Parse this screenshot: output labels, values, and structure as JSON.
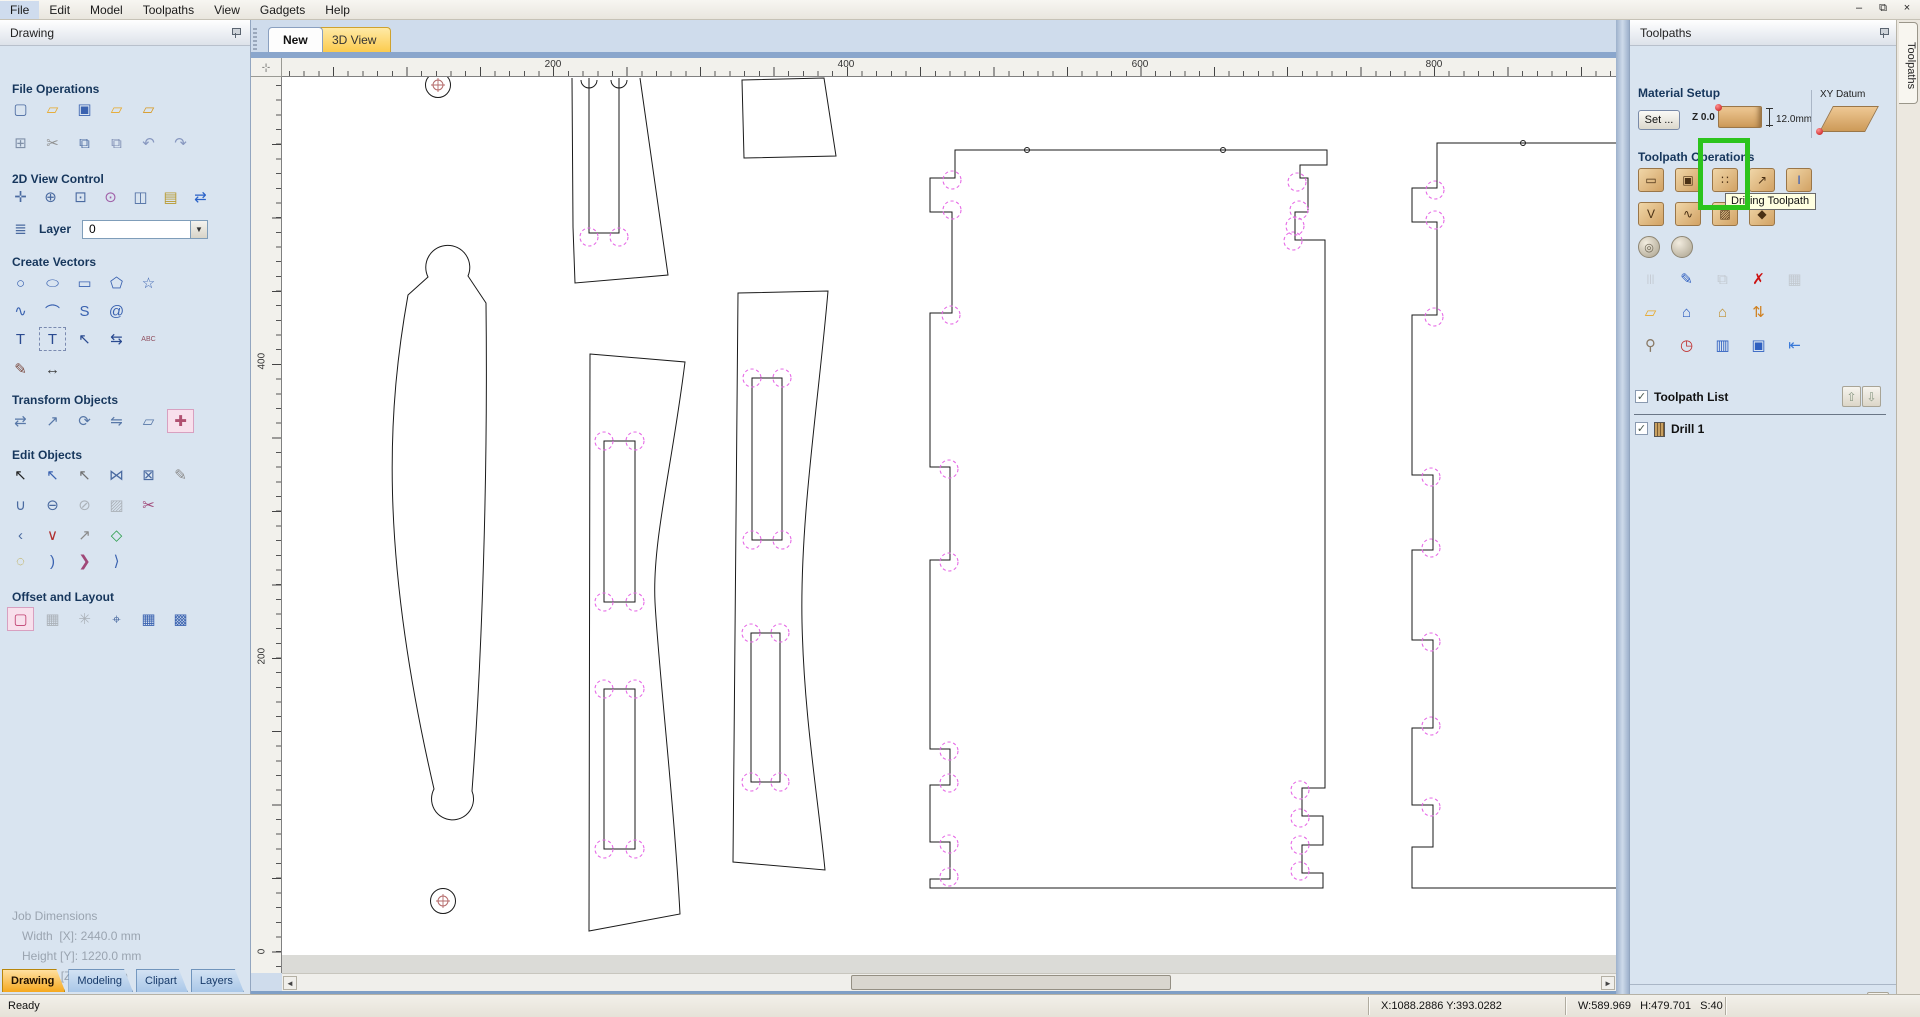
{
  "menu": {
    "items": [
      "File",
      "Edit",
      "Model",
      "Toolpaths",
      "View",
      "Gadgets",
      "Help"
    ]
  },
  "window_controls": {
    "minimize": "–",
    "restore": "⧉",
    "close": "×"
  },
  "drawing_panel": {
    "title": "Drawing",
    "headings": {
      "file_operations": "File Operations",
      "view_control": "2D View Control",
      "create_vectors": "Create Vectors",
      "transform_objects": "Transform Objects",
      "edit_objects": "Edit Objects",
      "offset_layout": "Offset and Layout"
    },
    "layer": {
      "label": "Layer",
      "value": "0"
    },
    "icons": {
      "file_row1": [
        {
          "n": "new-file",
          "g": "▢",
          "c": "#4a6aa0"
        },
        {
          "n": "open-file",
          "g": "▱",
          "c": "#e8a828"
        },
        {
          "n": "save-file",
          "g": "▣",
          "c": "#3a62b0"
        },
        {
          "n": "import-vectors",
          "g": "▱",
          "c": "#e8a828"
        },
        {
          "n": "export-vectors",
          "g": "▱",
          "c": "#d8981f"
        }
      ],
      "file_row2": [
        {
          "n": "job-setup",
          "g": "⊞",
          "c": "#8090a8"
        },
        {
          "n": "cut",
          "g": "✂",
          "c": "#909090"
        },
        {
          "n": "copy",
          "g": "⧉",
          "c": "#4a6aa0"
        },
        {
          "n": "paste",
          "g": "⧉",
          "c": "#7a8ab0"
        },
        {
          "n": "undo",
          "g": "↶",
          "c": "#8898c0"
        },
        {
          "n": "redo",
          "g": "↷",
          "c": "#8898c0"
        }
      ],
      "view2d": [
        {
          "n": "pan-view",
          "g": "✛",
          "c": "#4a6aa0"
        },
        {
          "n": "zoom-interactive",
          "g": "⊕",
          "c": "#4a6aa0"
        },
        {
          "n": "zoom-box",
          "g": "⊡",
          "c": "#4a6aa0"
        },
        {
          "n": "zoom-selected",
          "g": "⊙",
          "c": "#a060a8"
        },
        {
          "n": "zoom-fit",
          "g": "◫",
          "c": "#4a6aa0"
        },
        {
          "n": "zoom-extents",
          "g": "▤",
          "c": "#b89a30"
        },
        {
          "n": "switch-view",
          "g": "⇄",
          "c": "#2a62c8"
        }
      ],
      "layer_icon": [
        {
          "n": "layers",
          "g": "≣",
          "c": "#4a6aa0"
        }
      ],
      "cv_row1": [
        {
          "n": "draw-circle",
          "g": "○",
          "c": "#3a62b0"
        },
        {
          "n": "draw-ellipse",
          "g": "⬭",
          "c": "#3a62b0"
        },
        {
          "n": "draw-rectangle",
          "g": "▭",
          "c": "#3a62b0"
        },
        {
          "n": "draw-polygon",
          "g": "⬠",
          "c": "#3a62b0"
        },
        {
          "n": "draw-star",
          "g": "☆",
          "c": "#3a62b0"
        }
      ],
      "cv_row2": [
        {
          "n": "draw-polyline",
          "g": "∿",
          "c": "#3a62b0"
        },
        {
          "n": "draw-arc",
          "g": "⌒",
          "c": "#3a62b0"
        },
        {
          "n": "draw-curve",
          "g": "S",
          "c": "#3a62b0"
        },
        {
          "n": "draw-spiral",
          "g": "@",
          "c": "#3a62b0"
        }
      ],
      "cv_row3": [
        {
          "n": "draw-text",
          "g": "T",
          "c": "#2a4a90"
        },
        {
          "n": "draw-text-box",
          "g": "T",
          "c": "#2a4a90",
          "box": true
        },
        {
          "n": "edit-text",
          "g": "↖",
          "c": "#2a4a90"
        },
        {
          "n": "text-spacing",
          "g": "⇆",
          "c": "#2a4a90"
        },
        {
          "n": "text-on-arc",
          "g": "ABC",
          "c": "#905060",
          "fs": 7
        }
      ],
      "cv_row4": [
        {
          "n": "freehand-sketch",
          "g": "✎",
          "c": "#7a4a40"
        },
        {
          "n": "dimension",
          "g": "↔",
          "c": "#404040"
        }
      ],
      "transform_row": [
        {
          "n": "move-selection",
          "g": "⇄",
          "c": "#5878a8"
        },
        {
          "n": "set-size",
          "g": "↗",
          "c": "#5878a8"
        },
        {
          "n": "rotate",
          "g": "⟳",
          "c": "#5878a8"
        },
        {
          "n": "mirror",
          "g": "⇋",
          "c": "#5878a8"
        },
        {
          "n": "distort",
          "g": "▱",
          "c": "#5878a8"
        },
        {
          "n": "align-objects",
          "g": "✚",
          "c": "#b05070",
          "sel": true
        }
      ],
      "edit_row1": [
        {
          "n": "select-tool",
          "g": "↖",
          "c": "#222222"
        },
        {
          "n": "node-edit",
          "g": "↖",
          "c": "#3a62b0"
        },
        {
          "n": "move-nodes",
          "g": "↖",
          "c": "#707070"
        },
        {
          "n": "join-vectors",
          "g": "⋈",
          "c": "#4a6aa0"
        },
        {
          "n": "close-vector",
          "g": "⊠",
          "c": "#4a6aa0"
        },
        {
          "n": "measure-tool",
          "g": "✎",
          "c": "#8a8a8a"
        }
      ],
      "edit_row2": [
        {
          "n": "weld-vectors",
          "g": "∪",
          "c": "#4a6aa0"
        },
        {
          "n": "subtract-vectors",
          "g": "⊖",
          "c": "#4a6aa0"
        },
        {
          "n": "trim-vectors",
          "g": "⊘",
          "c": "#4a6aa0",
          "gray": true
        },
        {
          "n": "slice-vectors",
          "g": "▨",
          "c": "#4a6aa0",
          "gray": true
        },
        {
          "n": "vector-scissors",
          "g": "✂",
          "c": "#a04878"
        }
      ],
      "edit_row3": [
        {
          "n": "fillet-tool",
          "g": "‹",
          "c": "#4a6aa0"
        },
        {
          "n": "insert-node",
          "g": "∨",
          "c": "#b03030"
        },
        {
          "n": "extend-vector",
          "g": "↗",
          "c": "#8a8a8a"
        },
        {
          "n": "fit-curves",
          "g": "◇",
          "c": "#30a050"
        }
      ],
      "edit_row4": [
        {
          "n": "show-nodes",
          "g": "◌",
          "c": "#b8a030"
        },
        {
          "n": "fit-arc-1",
          "g": ")",
          "c": "#3a62b0"
        },
        {
          "n": "fit-arc-2",
          "g": "❯",
          "c": "#a04878"
        },
        {
          "n": "fit-arc-3",
          "g": "⟩",
          "c": "#3a62b0"
        }
      ],
      "offset_row": [
        {
          "n": "offset-vectors",
          "g": "▢",
          "c": "#c04070",
          "sel": true
        },
        {
          "n": "array-copy",
          "g": "▦",
          "c": "#4a6aa0",
          "gray": true
        },
        {
          "n": "circular-array",
          "g": "✳",
          "c": "#4a6aa0",
          "gray": true
        },
        {
          "n": "nest-parts",
          "g": "⌖",
          "c": "#4a6aa0"
        },
        {
          "n": "block-copy",
          "g": "▦",
          "c": "#3a62b0"
        },
        {
          "n": "nesting-layout",
          "g": "▩",
          "c": "#3a62b0"
        }
      ]
    },
    "job_dimensions": {
      "title": "Job Dimensions",
      "width": "Width  [X]: 2440.0 mm",
      "height": "Height [Y]: 1220.0 mm",
      "depth": "Depth  [Z]: 12.0 mm"
    },
    "tabs": [
      {
        "label": "Drawing",
        "active": true
      },
      {
        "label": "Modeling",
        "active": false
      },
      {
        "label": "Clipart",
        "active": false
      },
      {
        "label": "Layers",
        "active": false
      }
    ]
  },
  "canvas": {
    "tabs": [
      {
        "label": "New"
      },
      {
        "label": "3D View"
      }
    ],
    "h_ruler": [
      {
        "label": "200",
        "x": 271
      },
      {
        "label": "400",
        "x": 564
      },
      {
        "label": "600",
        "x": 858
      },
      {
        "label": "800",
        "x": 1152
      }
    ],
    "v_ruler": [
      {
        "label": "400",
        "y": 280
      },
      {
        "label": "200",
        "y": 575
      },
      {
        "label": "0",
        "y": 869
      }
    ],
    "drawing": {
      "outline_color": "#1a1a1a",
      "preview_color": "#e66ae6",
      "marker_color": "#b46a6a",
      "paths": [
        {
          "n": "part-spreader-outline",
          "d": "M290,1 L291,150 L293,206 L386,198 L358,1"
        },
        {
          "n": "part-spreader-slot",
          "d": "M307,1 L307,156 L337,156 L337,1"
        },
        {
          "n": "part-spreader-arc-1",
          "d": "M299,3 A8,8 0 0 0 315,3"
        },
        {
          "n": "part-spreader-arc-2",
          "d": "M329,3 A8,8 0 0 0 345,3"
        },
        {
          "n": "part-wedge",
          "d": "M460,3 L542,1 L554,79 L462,81 Z"
        },
        {
          "n": "part-curved-leg",
          "d": "M126,218 C106,330 96,470 152,712 A21,21 0 1 0 190,714 C200,580 206,400 204,226 L186,199 A22,22 0 1 0 146,200 Z"
        },
        {
          "n": "part-slat-1",
          "d": "M308,277 L403,285 C390,390 370,465 373,525 C376,585 392,725 398,837 L307,854 Z"
        },
        {
          "n": "part-slat-1-slot-1",
          "d": "M322,364 h31 v161 h-31 Z"
        },
        {
          "n": "part-slat-1-slot-2",
          "d": "M322,612 h31 v160 h-31 Z"
        },
        {
          "n": "part-slat-2",
          "d": "M456,216 L451,785 L543,793 C536,720 522,640 520,545 C518,440 536,330 546,214 Z"
        },
        {
          "n": "part-slat-2-slot-1",
          "d": "M470,301 h30 v162 h-30 Z"
        },
        {
          "n": "part-slat-2-slot-2",
          "d": "M469,556 h29 v149 h-29 Z"
        },
        {
          "n": "part-side-panel",
          "d": "M673,73 L1045,73 L1045,88 L1018,88 L1018,101 L1026,101 L1026,135 L1013,135 L1013,163 L1043,163 L1043,711 L1020,711 L1020,739 L1041,739 L1041,768 L1020,768 L1020,796 L1041,796 L1041,811 L648,811 L648,802 L668,802 L668,765 L648,765 L648,708 L668,708 L668,672 L648,672 L648,483 L668,483 L668,390 L648,390 L648,236 L670,236 L670,135 L648,135 L648,101 L673,101 Z"
        },
        {
          "n": "part-side-panel-2",
          "d": "M1334,66 L1155,66 L1155,111 L1130,111 L1130,145 L1155,145 L1155,238 L1130,238 L1130,398 L1151,398 L1151,473 L1130,473 L1130,563 L1151,563 L1151,651 L1130,651 L1130,728 L1151,728 L1151,770 L1130,770 L1130,811 L1334,811"
        }
      ],
      "dashed_circles": [
        [
          307,
          160
        ],
        [
          337,
          160
        ],
        [
          322,
          364
        ],
        [
          353,
          364
        ],
        [
          322,
          525
        ],
        [
          353,
          525
        ],
        [
          322,
          612
        ],
        [
          353,
          612
        ],
        [
          322,
          772
        ],
        [
          353,
          772
        ],
        [
          470,
          301
        ],
        [
          500,
          301
        ],
        [
          470,
          463
        ],
        [
          500,
          463
        ],
        [
          469,
          556
        ],
        [
          498,
          556
        ],
        [
          469,
          705
        ],
        [
          498,
          705
        ],
        [
          670,
          103
        ],
        [
          670,
          133
        ],
        [
          669,
          238
        ],
        [
          667,
          392
        ],
        [
          667,
          485
        ],
        [
          667,
          674
        ],
        [
          667,
          706
        ],
        [
          667,
          767
        ],
        [
          667,
          800
        ],
        [
          1015,
          105
        ],
        [
          1017,
          133
        ],
        [
          1013,
          149
        ],
        [
          1011,
          164
        ],
        [
          1018,
          713
        ],
        [
          1018,
          741
        ],
        [
          1018,
          768
        ],
        [
          1018,
          794
        ],
        [
          1153,
          113
        ],
        [
          1153,
          143
        ],
        [
          1152,
          240
        ],
        [
          1149,
          400
        ],
        [
          1149,
          471
        ],
        [
          1149,
          565
        ],
        [
          1149,
          649
        ],
        [
          1149,
          730
        ]
      ],
      "small_circles": [
        [
          745,
          73
        ],
        [
          941,
          73
        ],
        [
          1241,
          66
        ]
      ],
      "markers": [
        {
          "x": 156,
          "y": 8
        },
        {
          "x": 161,
          "y": 824
        }
      ]
    }
  },
  "toolpaths_panel": {
    "title": "Toolpaths",
    "material_setup": {
      "heading": "Material Setup",
      "set_button": "Set ...",
      "z_label": "Z 0.0",
      "thickness": "12.0mm",
      "xy_datum_label": "XY Datum"
    },
    "operations": {
      "heading": "Toolpath Operations",
      "tooltip": "Drilling Toolpath",
      "rows": {
        "r1": [
          {
            "n": "profile-toolpath",
            "g": "▭",
            "tile": true
          },
          {
            "n": "pocket-toolpath",
            "g": "▣",
            "tile": true
          },
          {
            "n": "drilling-toolpath",
            "g": "∷",
            "tile": true
          },
          {
            "n": "quick-engrave-toolpath",
            "g": "↗",
            "tile": true
          },
          {
            "n": "inlay-toolpath",
            "g": "I",
            "tile": true,
            "c": "#2050c0"
          }
        ],
        "r2": [
          {
            "n": "vcarve-toolpath",
            "g": "V",
            "tile": true
          },
          {
            "n": "fluting-toolpath",
            "g": "∿",
            "tile": true
          },
          {
            "n": "texture-toolpath",
            "g": "▨",
            "tile": true
          },
          {
            "n": "prism-toolpath",
            "g": "◆",
            "tile": true
          }
        ],
        "r3": [
          {
            "n": "rough-3d-toolpath",
            "g": "◎",
            "sphere": true
          },
          {
            "n": "finish-3d-toolpath",
            "g": "",
            "sphere": true
          }
        ],
        "r4": [
          {
            "n": "tool-list",
            "g": "|||",
            "c": "#9aa0a8",
            "fs": 10,
            "gray": true
          },
          {
            "n": "edit-toolpath",
            "g": "✎",
            "c": "#3060c0"
          },
          {
            "n": "duplicate-toolpath",
            "g": "⧉",
            "c": "#9aa0b0",
            "gray": true
          },
          {
            "n": "delete-toolpath",
            "g": "✗",
            "c": "#cc1010"
          },
          {
            "n": "recalculate-toolpaths",
            "g": "▦",
            "c": "#9aa0b0",
            "gray": true
          }
        ],
        "r5": [
          {
            "n": "load-toolpath",
            "g": "▱",
            "c": "#e8a828"
          },
          {
            "n": "save-toolpath-template",
            "g": "⌂",
            "c": "#3060c0"
          },
          {
            "n": "save-all-templates",
            "g": "⌂",
            "c": "#c09030"
          },
          {
            "n": "merge-toolpaths",
            "g": "⇅",
            "c": "#d08020"
          }
        ],
        "r6": [
          {
            "n": "tool-database",
            "g": "⚲",
            "c": "#8a7a66"
          },
          {
            "n": "estimate-machining-time",
            "g": "◷",
            "c": "#c03030"
          },
          {
            "n": "toolpath-summary",
            "g": "▥",
            "c": "#3060c0"
          },
          {
            "n": "save-toolpath",
            "g": "▣",
            "c": "#3060c0"
          },
          {
            "n": "dock-toolbar",
            "g": "⇤",
            "c": "#3878d8"
          }
        ]
      }
    },
    "toolpath_list": {
      "heading": "Toolpath List",
      "header_checked": true,
      "up_arrow": "⇧",
      "down_arrow": "⇩",
      "items": [
        {
          "label": "Drill 1",
          "checked": true
        }
      ]
    },
    "footer": {
      "show_2d_label": "Show 2D previews",
      "show_2d_checked": true,
      "solid_label": "Solid",
      "solid_checked": false
    }
  },
  "right_tab": {
    "label": "Toolpaths"
  },
  "status_bar": {
    "ready": "Ready",
    "xy": "X:1088.2886 Y:393.0282",
    "whs": "W:589.969   H:479.701   S:40"
  }
}
